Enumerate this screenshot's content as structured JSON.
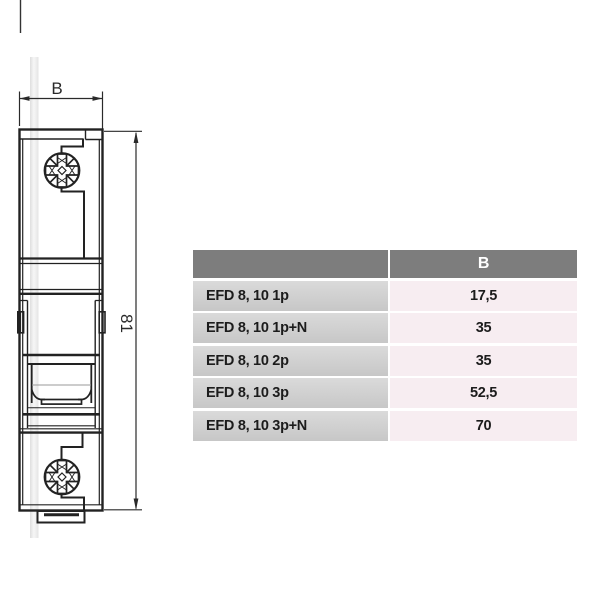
{
  "drawing": {
    "dim_width_label": "B",
    "dim_height_label": "81",
    "line_color": "#222222",
    "watermark_color": "#e7e7e7"
  },
  "table": {
    "header": {
      "col1": "",
      "col2": "B"
    },
    "rows": [
      {
        "label": "EFD 8, 10 1p",
        "value": "17,5"
      },
      {
        "label": "EFD 8, 10 1p+N",
        "value": "35"
      },
      {
        "label": "EFD 8, 10 2p",
        "value": "35"
      },
      {
        "label": "EFD 8, 10 3p",
        "value": "52,5"
      },
      {
        "label": "EFD 8, 10 3p+N",
        "value": "70"
      }
    ],
    "colors": {
      "header_bg": "#7d7d7d",
      "header_text": "#ffffff",
      "label_cell_bg": "#cfcfcf",
      "value_cell_bg": "#f7edf1",
      "cell_text": "#1c1c1c"
    }
  }
}
